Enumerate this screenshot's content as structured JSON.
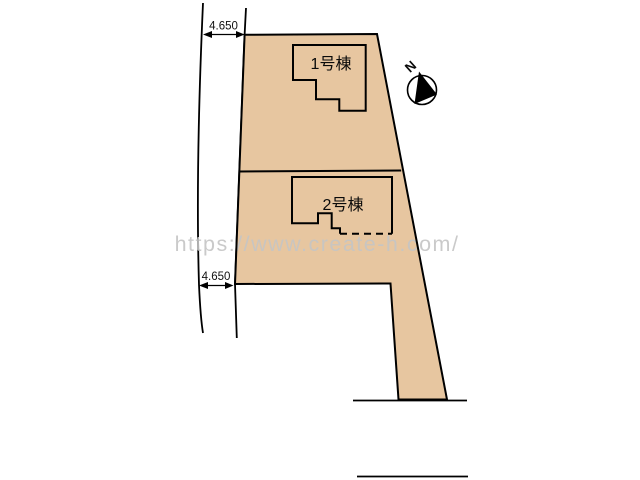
{
  "plan": {
    "type": "site-layout-plan",
    "lot_fill": "#e7c6a0",
    "outline_color": "#000000",
    "watermark_color": "#c5c5c5",
    "buildings": [
      {
        "label": "1号棟"
      },
      {
        "label": "2号棟"
      }
    ],
    "dimensions": [
      {
        "value": "4.650"
      },
      {
        "value": "4.650"
      }
    ],
    "compass": {
      "label": "N"
    },
    "watermark": "https://www.create-h.com/"
  }
}
